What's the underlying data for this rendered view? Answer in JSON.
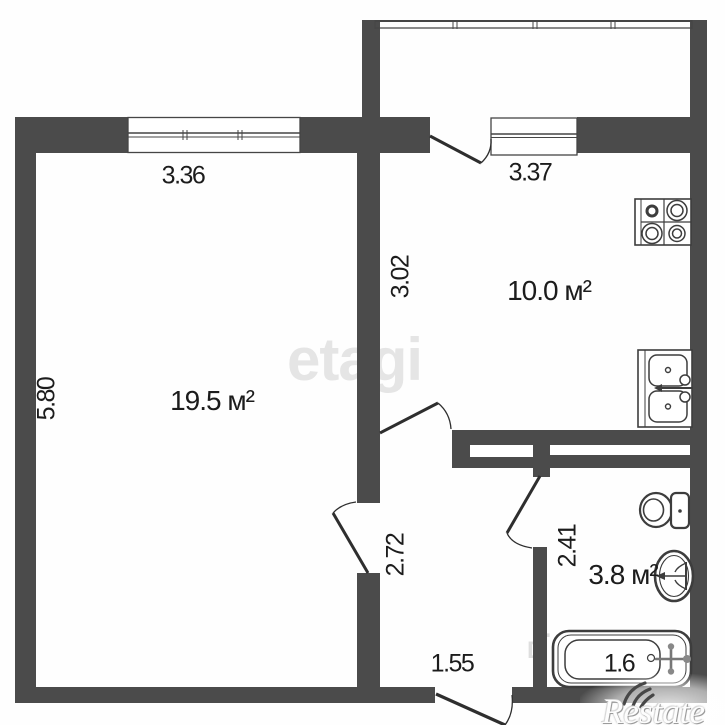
{
  "plan": {
    "type": "apartment-floor-plan",
    "rooms": [
      {
        "id": "living-room",
        "area_label": "19.5 м²"
      },
      {
        "id": "kitchen",
        "area_label": "10.0 м²"
      },
      {
        "id": "bathroom",
        "area_label": "3.8 м²"
      }
    ],
    "dimensions": {
      "living_width": "3.36",
      "kitchen_width": "3.37",
      "kitchen_depth": "3.02",
      "living_depth": "5.80",
      "hall_depth": "2.72",
      "bath_depth": "2.41",
      "hall_width": "1.55",
      "bathtub_length": "1.6"
    },
    "fixtures": [
      "stove-icon",
      "kitchen-sink-icon",
      "toilet-icon",
      "bathroom-sink-icon",
      "bathtub-icon"
    ],
    "watermarks": {
      "center": "etagi",
      "corner": "Restate",
      "faint_letter_1": "L",
      "faint_letter_2": "D"
    },
    "colors": {
      "wall": "#4b4b4b",
      "line": "#3a3a3a",
      "text": "#1c1c1c",
      "watermark_gray": "#e5e5e5"
    }
  }
}
